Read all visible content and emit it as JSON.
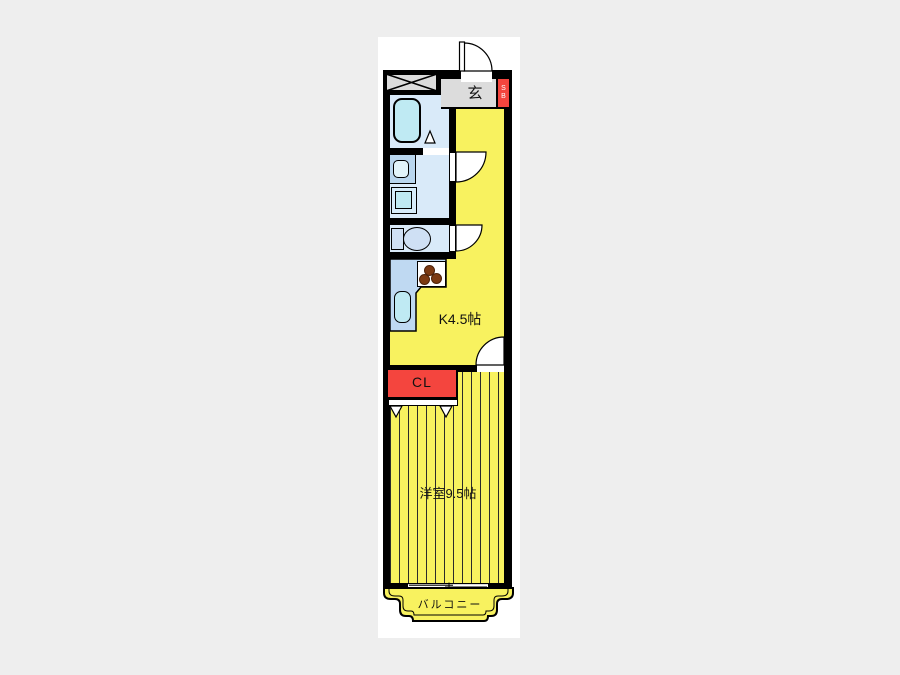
{
  "floorplan": {
    "labels": {
      "entrance": "玄",
      "shoe_box_line1": "S",
      "shoe_box_line2": "B",
      "kitchen": "K4.5帖",
      "closet": "CL",
      "western_room": "洋室9.5帖",
      "balcony": "バルコニー"
    },
    "colors": {
      "floor_yellow": "#F8F25F",
      "wet_room_blue": "#D9EAF9",
      "fixture_cyan": "#BFEAF3",
      "counter_blue": "#BFD9F2",
      "accent_red": "#F4453E",
      "entrance_gray": "#DCDCDC",
      "wall_black": "#000000",
      "page_background": "#EEEEEE"
    },
    "fixtures": [
      "meter-box",
      "entrance-door",
      "bathtub",
      "bathroom-folding-door",
      "washbasin",
      "washing-machine-pan",
      "washroom-door",
      "toilet",
      "toilet-door",
      "kitchen-counter",
      "stove",
      "kitchen-sink",
      "room-door",
      "closet-folding-door",
      "sliding-window",
      "balcony"
    ]
  }
}
